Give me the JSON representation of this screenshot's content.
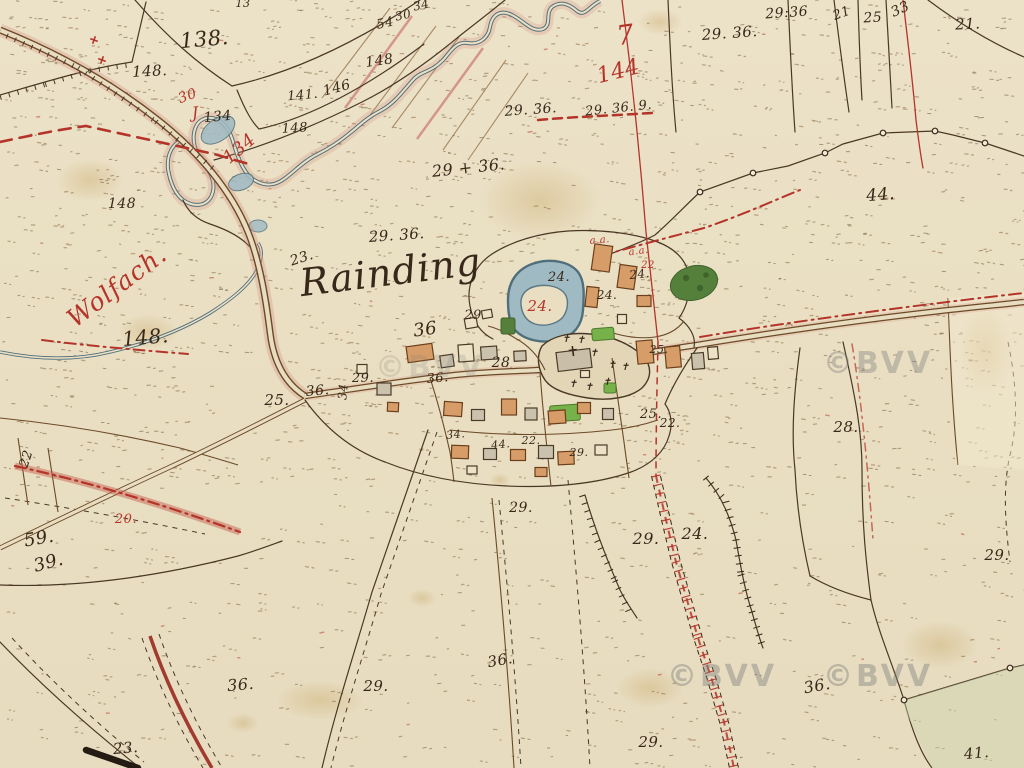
{
  "meta": {
    "title": "Historische Katasterkarte – Rainding an der Wolfach"
  },
  "palette": {
    "paper": "#ebe0c4",
    "ink": "#38281a",
    "red": "#b5342a",
    "water": "#9fbac3",
    "water_edge": "#51707c",
    "building_wood": "#d79d68",
    "building_stone": "#cbc2ae",
    "building_open": "#ece2c6",
    "garden_green": "#76b14a",
    "tree_green": "#55803c",
    "road_pink": "#d4877c",
    "watermark_gray": "#7d7d7d"
  },
  "place_labels": {
    "village": "Rainding",
    "river": "Wolfach.",
    "red_sheet_mark": "7",
    "red_sheet_number": "144"
  },
  "watermark": {
    "text": "©BVV",
    "positions": [
      {
        "x": 722,
        "y": 686,
        "o": 0.42
      },
      {
        "x": 878,
        "y": 686,
        "o": 0.42
      },
      {
        "x": 430,
        "y": 377,
        "o": 0.2
      },
      {
        "x": 878,
        "y": 373,
        "o": 0.38
      }
    ]
  },
  "parcel_labels": [
    {
      "t": "138.",
      "x": 205,
      "y": 46,
      "s": 21,
      "c": "ink",
      "r": -5
    },
    {
      "t": "148.",
      "x": 150,
      "y": 76,
      "s": 15,
      "c": "ink",
      "r": -3
    },
    {
      "t": "54",
      "x": 386,
      "y": 27,
      "s": 13,
      "c": "ink",
      "r": -12
    },
    {
      "t": "30",
      "x": 404,
      "y": 19,
      "s": 12,
      "c": "ink",
      "r": -12
    },
    {
      "t": "34",
      "x": 422,
      "y": 9,
      "s": 12,
      "c": "ink",
      "r": -12
    },
    {
      "t": "148",
      "x": 380,
      "y": 65,
      "s": 14,
      "c": "ink",
      "r": -8
    },
    {
      "t": "13",
      "x": 243,
      "y": 7,
      "s": 11,
      "c": "ink",
      "r": 0
    },
    {
      "t": "141.",
      "x": 303,
      "y": 99,
      "s": 13,
      "c": "ink",
      "r": -5
    },
    {
      "t": "146",
      "x": 338,
      "y": 92,
      "s": 14,
      "c": "ink",
      "r": -15
    },
    {
      "t": "148",
      "x": 295,
      "y": 132,
      "s": 13,
      "c": "ink",
      "r": -3
    },
    {
      "t": "30",
      "x": 189,
      "y": 100,
      "s": 14,
      "c": "red",
      "r": -20
    },
    {
      "t": "J",
      "x": 196,
      "y": 118,
      "s": 16,
      "c": "red",
      "r": -5,
      "k": "script"
    },
    {
      "t": "134",
      "x": 218,
      "y": 121,
      "s": 14,
      "c": "ink",
      "r": -5
    },
    {
      "t": "134",
      "x": 243,
      "y": 153,
      "s": 18,
      "c": "red",
      "r": -40
    },
    {
      "t": "148",
      "x": 122,
      "y": 208,
      "s": 14,
      "c": "ink",
      "r": 0
    },
    {
      "t": "Wolfach.",
      "x": 122,
      "y": 293,
      "s": 25,
      "c": "red",
      "r": -37,
      "k": "script",
      "name": "river-name-label"
    },
    {
      "t": "148.",
      "x": 146,
      "y": 344,
      "s": 20,
      "c": "ink",
      "r": -5
    },
    {
      "t": "7",
      "x": 627,
      "y": 44,
      "s": 27,
      "c": "red",
      "r": -8,
      "k": "script"
    },
    {
      "t": "144",
      "x": 620,
      "y": 78,
      "s": 22,
      "c": "red",
      "r": -14
    },
    {
      "t": "29. 36.",
      "x": 730,
      "y": 38,
      "s": 15,
      "c": "ink",
      "r": -4
    },
    {
      "t": "29:36",
      "x": 787,
      "y": 17,
      "s": 14,
      "c": "ink",
      "r": -4
    },
    {
      "t": "21",
      "x": 843,
      "y": 17,
      "s": 13,
      "c": "ink",
      "r": -20
    },
    {
      "t": "25",
      "x": 873,
      "y": 22,
      "s": 14,
      "c": "ink",
      "r": -3
    },
    {
      "t": "33",
      "x": 902,
      "y": 13,
      "s": 14,
      "c": "ink",
      "r": -25
    },
    {
      "t": "21.",
      "x": 968,
      "y": 29,
      "s": 15,
      "c": "ink",
      "r": -3
    },
    {
      "t": "29. 36.",
      "x": 531,
      "y": 114,
      "s": 14,
      "c": "ink",
      "r": -4
    },
    {
      "t": "29. 36. 9.",
      "x": 619,
      "y": 112,
      "s": 13,
      "c": "ink",
      "r": -6
    },
    {
      "t": "29 + 36.",
      "x": 469,
      "y": 173,
      "s": 16,
      "c": "ink",
      "r": -6
    },
    {
      "t": "29. 36.",
      "x": 397,
      "y": 240,
      "s": 15,
      "c": "ink",
      "r": -4
    },
    {
      "t": "23.",
      "x": 303,
      "y": 262,
      "s": 14,
      "c": "ink",
      "r": -18
    },
    {
      "t": "Rainding",
      "x": 392,
      "y": 285,
      "s": 38,
      "c": "ink",
      "r": -7,
      "k": "script",
      "name": "village-name-label"
    },
    {
      "t": "44.",
      "x": 881,
      "y": 200,
      "s": 17,
      "c": "ink",
      "r": -5
    },
    {
      "t": "29",
      "x": 473,
      "y": 319,
      "s": 13,
      "c": "ink",
      "r": 0
    },
    {
      "t": "24.",
      "x": 559,
      "y": 281,
      "s": 13,
      "c": "ink",
      "r": 0
    },
    {
      "t": "24.",
      "x": 540,
      "y": 311,
      "s": 15,
      "c": "red",
      "r": 0
    },
    {
      "t": "24.",
      "x": 607,
      "y": 299,
      "s": 12,
      "c": "ink",
      "r": 0
    },
    {
      "t": "24.",
      "x": 640,
      "y": 278,
      "s": 12,
      "c": "ink",
      "r": -6
    },
    {
      "t": "a.a.",
      "x": 600,
      "y": 243,
      "s": 10,
      "c": "red",
      "r": -5
    },
    {
      "t": "a.a.",
      "x": 639,
      "y": 254,
      "s": 10,
      "c": "red",
      "r": -8
    },
    {
      "t": "22",
      "x": 648,
      "y": 268,
      "s": 10,
      "c": "red",
      "r": 0
    },
    {
      "t": "36",
      "x": 426,
      "y": 335,
      "s": 18,
      "c": "ink",
      "r": -8
    },
    {
      "t": "28",
      "x": 501,
      "y": 367,
      "s": 14,
      "c": "ink",
      "r": 0
    },
    {
      "t": "25.",
      "x": 277,
      "y": 405,
      "s": 15,
      "c": "ink",
      "r": 0
    },
    {
      "t": "36.",
      "x": 318,
      "y": 395,
      "s": 14,
      "c": "ink",
      "r": -5
    },
    {
      "t": "34",
      "x": 347,
      "y": 392,
      "s": 12,
      "c": "ink",
      "r": -85
    },
    {
      "t": "29.",
      "x": 363,
      "y": 382,
      "s": 13,
      "c": "ink",
      "r": 0
    },
    {
      "t": "36.",
      "x": 438,
      "y": 382,
      "s": 13,
      "c": "ink",
      "r": -5
    },
    {
      "t": "25.",
      "x": 659,
      "y": 353,
      "s": 11,
      "c": "ink",
      "r": 0
    },
    {
      "t": "25.",
      "x": 651,
      "y": 418,
      "s": 13,
      "c": "ink",
      "r": 0
    },
    {
      "t": "22.",
      "x": 670,
      "y": 427,
      "s": 12,
      "c": "ink",
      "r": 0
    },
    {
      "t": "28.",
      "x": 846,
      "y": 432,
      "s": 15,
      "c": "ink",
      "r": 0
    },
    {
      "t": "34.",
      "x": 456,
      "y": 438,
      "s": 11,
      "c": "ink",
      "r": -5
    },
    {
      "t": "44.",
      "x": 501,
      "y": 448,
      "s": 11,
      "c": "ink",
      "r": -5
    },
    {
      "t": "22.",
      "x": 531,
      "y": 444,
      "s": 11,
      "c": "ink",
      "r": 0
    },
    {
      "t": "29.",
      "x": 579,
      "y": 456,
      "s": 11,
      "c": "ink",
      "r": 0
    },
    {
      "t": "29.",
      "x": 521,
      "y": 512,
      "s": 14,
      "c": "ink",
      "r": 0
    },
    {
      "t": "29.",
      "x": 646,
      "y": 544,
      "s": 16,
      "c": "ink",
      "r": 0
    },
    {
      "t": "24.",
      "x": 695,
      "y": 539,
      "s": 16,
      "c": "ink",
      "r": 0
    },
    {
      "t": "20.",
      "x": 126,
      "y": 523,
      "s": 13,
      "c": "red",
      "r": 0
    },
    {
      "t": "22",
      "x": 30,
      "y": 460,
      "s": 13,
      "c": "ink",
      "r": -72
    },
    {
      "t": "59.",
      "x": 40,
      "y": 544,
      "s": 18,
      "c": "ink",
      "r": -10
    },
    {
      "t": "39.",
      "x": 50,
      "y": 568,
      "s": 18,
      "c": "ink",
      "r": -15
    },
    {
      "t": "29.",
      "x": 997,
      "y": 560,
      "s": 15,
      "c": "ink",
      "r": 0
    },
    {
      "t": "36.",
      "x": 241,
      "y": 690,
      "s": 16,
      "c": "ink",
      "r": -5
    },
    {
      "t": "29.",
      "x": 376,
      "y": 691,
      "s": 15,
      "c": "ink",
      "r": 0
    },
    {
      "t": "36.",
      "x": 501,
      "y": 665,
      "s": 15,
      "c": "ink",
      "r": -10
    },
    {
      "t": "36.",
      "x": 818,
      "y": 691,
      "s": 16,
      "c": "ink",
      "r": -10
    },
    {
      "t": "29.",
      "x": 651,
      "y": 747,
      "s": 15,
      "c": "ink",
      "r": 0
    },
    {
      "t": "23.",
      "x": 126,
      "y": 753,
      "s": 15,
      "c": "ink",
      "r": -5
    },
    {
      "t": "41.",
      "x": 977,
      "y": 758,
      "s": 15,
      "c": "ink",
      "r": -5
    }
  ],
  "symbols": {
    "cemetery_crosses": [
      [
        566,
        342
      ],
      [
        581,
        343
      ],
      [
        594,
        356
      ],
      [
        612,
        368
      ],
      [
        625,
        370
      ],
      [
        573,
        387
      ],
      [
        589,
        390
      ],
      [
        607,
        385
      ]
    ],
    "red_crosses": [
      [
        102,
        60
      ],
      [
        94,
        40
      ]
    ],
    "survey_points": [
      [
        700,
        192
      ],
      [
        753,
        173
      ],
      [
        825,
        153
      ],
      [
        883,
        133
      ],
      [
        935,
        131
      ],
      [
        985,
        143
      ],
      [
        904,
        700
      ],
      [
        1010,
        668
      ]
    ]
  }
}
